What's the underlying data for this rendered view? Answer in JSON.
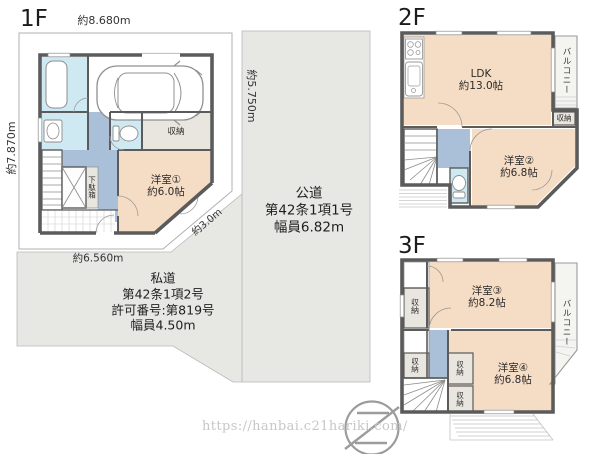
{
  "floors": {
    "f1": {
      "label": "1F",
      "dim_top": "約8.680m",
      "dim_left": "約7.870m",
      "dim_right": "約5.750m",
      "dim_bottom": "約6.560m",
      "dim_diagonal": "約3.0m",
      "bedroom1_name": "洋室①",
      "bedroom1_size": "約6.0帖",
      "closet": "収納",
      "shoe_cabinet": "下駄箱"
    },
    "f2": {
      "label": "2F",
      "ldk_name": "LDK",
      "ldk_size": "約13.0帖",
      "bedroom2_name": "洋室②",
      "bedroom2_size": "約6.8帖",
      "balcony": "バルコニー",
      "closet": "収納"
    },
    "f3": {
      "label": "3F",
      "bedroom3_name": "洋室③",
      "bedroom3_size": "約8.2帖",
      "bedroom4_name": "洋室④",
      "bedroom4_size": "約6.8帖",
      "balcony": "バルコニー",
      "closets": [
        "収納",
        "収納",
        "収納",
        "収納"
      ]
    }
  },
  "roads": {
    "public": {
      "lines": [
        "公道",
        "第42条1項1号",
        "幅員6.82m"
      ]
    },
    "private": {
      "lines": [
        "私道",
        "第42条1項2号",
        "許可番号:第819号",
        "幅員4.50m"
      ]
    }
  },
  "watermark": {
    "url": "https://hanbai.c21hariki.com/"
  },
  "colors": {
    "room_peach": "#f5dcc5",
    "hall_blue": "#a9c0d8",
    "water_cyan": "#cfe9f3",
    "closet_gray": "#e8e6df",
    "road_gray": "#e7e7e4",
    "wall": "#5b5b5b"
  }
}
